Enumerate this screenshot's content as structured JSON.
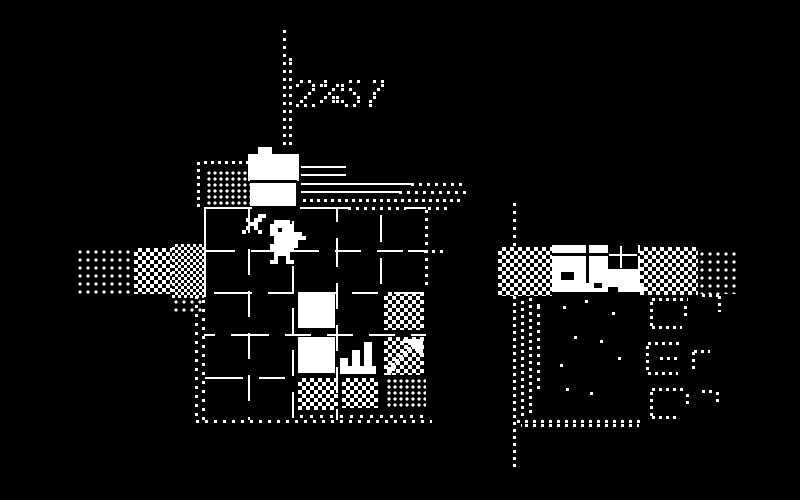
{
  "meta": {
    "title": "1-bit adventure game screen - hotel room with player, crates and neighboring house",
    "background": "#000000",
    "foreground": "#ffffff"
  },
  "hud": {
    "counter": "2%",
    "timer": "57",
    "style": "dotted-pixel-digits"
  },
  "glyphs": {
    "2": [
      ".X.X.",
      "X...X",
      "....X",
      "...X.",
      "..X..",
      ".X...",
      "X.X.X"
    ],
    "%": [
      "XX...",
      "XX..X",
      "...X.",
      "..X..",
      ".X.XX",
      "X..XX",
      "....."
    ],
    "5": [
      "X.X.X",
      "X....",
      "X.X..",
      "...X.",
      "....X",
      "X...X",
      ".X.X."
    ],
    "7": [
      "X.X.X",
      "....X",
      "...X.",
      "..X..",
      "..X..",
      ".X...",
      ".X..."
    ]
  },
  "sprites": {
    "player": [
      "..XXXX....",
      ".XXXXXX...",
      ".XX.XXX...",
      ".XXXXXXXX.",
      "..XXXXXXXX",
      "..XXXXXX..",
      ".XXXXXXX..",
      ".XXXXXX...",
      "..XXXX....",
      "..X..X....",
      ".XX..XX..."
    ],
    "sword": [
      "X...XX",
      ".X.XX.",
      "..XX..",
      ".X.X..",
      "X...X."
    ],
    "stairs": [
      "......XX.",
      "......XX.",
      "...XX.XX.",
      "...XX.XX.",
      "XX.XX.XX.",
      "XX.XX.XX.",
      "XXXXXXXXX",
      "XXXXXXXXX"
    ],
    "arrow": [
      "....XXXXX",
      "......XXX",
      ".....X.XX",
      "....X...X",
      "...X.....",
      "..X......",
      ".X.......",
      "XX.......",
      "X........"
    ]
  },
  "scene": {
    "width": 800,
    "height": 500,
    "elements": [
      {
        "n": "timer-pole-dotted-line",
        "t": "dv",
        "x": 283,
        "y": 30,
        "h": 120,
        "p": 8,
        "d": 3
      },
      {
        "n": "timer-pole-dotted-line-2",
        "t": "dv",
        "x": 289,
        "y": 58,
        "h": 92,
        "p": 8,
        "d": 3,
        "o": 4
      },
      {
        "n": "hud-counter",
        "t": "text",
        "x": 296,
        "y": 80,
        "tx": "2%"
      },
      {
        "n": "hud-timer",
        "t": "text",
        "x": 341,
        "y": 80,
        "tx": "57"
      },
      {
        "n": "roof-dotted-hline",
        "t": "dh",
        "x": 204,
        "y": 161,
        "w": 48,
        "p": 7,
        "d": 3
      },
      {
        "n": "roof-dotted-vline",
        "t": "dv",
        "x": 197,
        "y": 162,
        "h": 46,
        "p": 7,
        "d": 3
      },
      {
        "n": "storage-dither-block",
        "t": "dots",
        "x": 206,
        "y": 170,
        "w": 44,
        "h": 36,
        "p": 6,
        "d": 3
      },
      {
        "n": "reception-desk-tab",
        "t": "rect",
        "x": 258,
        "y": 147,
        "w": 14,
        "h": 8
      },
      {
        "n": "reception-desk-top",
        "t": "rect",
        "x": 248,
        "y": 154,
        "w": 51,
        "h": 27
      },
      {
        "n": "reception-desk-divider",
        "t": "rect",
        "x": 250,
        "y": 180,
        "w": 47,
        "h": 3,
        "c": "#000"
      },
      {
        "n": "reception-desk-front",
        "t": "rect",
        "x": 250,
        "y": 183,
        "w": 46,
        "h": 23
      },
      {
        "n": "shelf-line-1",
        "t": "hl",
        "x": 301,
        "y": 166,
        "w": 45
      },
      {
        "n": "shelf-line-2",
        "t": "hl",
        "x": 301,
        "y": 174,
        "w": 45
      },
      {
        "n": "shelf-line-3",
        "t": "hl",
        "x": 301,
        "y": 183,
        "w": 110
      },
      {
        "n": "shelf-line-3-dotted",
        "t": "dh",
        "x": 411,
        "y": 183,
        "w": 56,
        "p": 8,
        "d": 3
      },
      {
        "n": "shelf-line-4",
        "t": "hl",
        "x": 301,
        "y": 191,
        "w": 98
      },
      {
        "n": "shelf-line-4-dotted",
        "t": "dh",
        "x": 399,
        "y": 191,
        "w": 68,
        "p": 8,
        "d": 3
      },
      {
        "n": "shelf-line-5-dotted",
        "t": "dh",
        "x": 303,
        "y": 199,
        "w": 160,
        "p": 7,
        "d": 3
      },
      {
        "n": "room-top-wall-left",
        "t": "hl",
        "x": 204,
        "y": 207,
        "w": 48
      },
      {
        "n": "room-top-wall-mid",
        "t": "hl",
        "x": 300,
        "y": 207,
        "w": 48
      },
      {
        "n": "room-top-wall-dotted",
        "t": "dh",
        "x": 348,
        "y": 207,
        "w": 58,
        "p": 8,
        "d": 3
      },
      {
        "n": "room-top-wall-right",
        "t": "hl",
        "x": 406,
        "y": 207,
        "w": 20
      },
      {
        "n": "room-top-wall-dotted-2",
        "t": "dh",
        "x": 428,
        "y": 207,
        "w": 22,
        "p": 8,
        "d": 3
      },
      {
        "n": "room-left-wall",
        "t": "vl",
        "x": 204,
        "y": 207,
        "h": 90
      },
      {
        "n": "room-left-wall-dotted",
        "t": "dv",
        "x": 195,
        "y": 296,
        "h": 126,
        "p": 9,
        "d": 3
      },
      {
        "n": "room-left-wall-dotted-2",
        "t": "dv",
        "x": 202,
        "y": 296,
        "h": 126,
        "p": 9,
        "d": 3,
        "o": 4
      },
      {
        "n": "room-right-wall-dotted",
        "t": "dv",
        "x": 425,
        "y": 210,
        "h": 80,
        "p": 8,
        "d": 3
      },
      {
        "n": "room-bottom-wall-dotted",
        "t": "dh",
        "x": 196,
        "y": 420,
        "w": 236,
        "p": 9,
        "d": 3
      },
      {
        "n": "side-window-line",
        "t": "hl",
        "x": 408,
        "y": 250,
        "w": 14
      },
      {
        "n": "side-window-dotted",
        "t": "dh",
        "x": 424,
        "y": 250,
        "w": 22,
        "p": 8,
        "d": 3
      },
      {
        "n": "floor-grid-vline",
        "t": "dsv",
        "x": 248,
        "y": 207,
        "h": 213,
        "o": 0
      },
      {
        "n": "floor-grid-vline",
        "t": "dsv",
        "x": 292,
        "y": 207,
        "h": 213,
        "o": 17
      },
      {
        "n": "floor-grid-vline",
        "t": "dsv",
        "x": 336,
        "y": 207,
        "h": 213,
        "o": 34
      },
      {
        "n": "floor-grid-vline",
        "t": "dsv",
        "x": 380,
        "y": 207,
        "h": 85,
        "o": 9
      },
      {
        "n": "floor-grid-hline",
        "t": "dsh",
        "x": 204,
        "y": 250,
        "w": 222,
        "o": 5
      },
      {
        "n": "floor-grid-hline",
        "t": "dsh",
        "x": 204,
        "y": 292,
        "w": 222,
        "o": 22
      },
      {
        "n": "floor-grid-hline",
        "t": "dsh",
        "x": 204,
        "y": 334,
        "w": 222,
        "o": 39
      },
      {
        "n": "floor-grid-hline",
        "t": "dsh",
        "x": 204,
        "y": 377,
        "w": 96,
        "o": 13
      },
      {
        "n": "crate-tile",
        "t": "rect",
        "x": 298,
        "y": 292,
        "w": 37,
        "h": 36
      },
      {
        "n": "crate-tile",
        "t": "rect",
        "x": 298,
        "y": 337,
        "w": 37,
        "h": 36
      },
      {
        "n": "stairs-tile",
        "t": "sprite",
        "x": 340,
        "y": 342,
        "sp": "stairs",
        "s": 4
      },
      {
        "n": "checker-tile",
        "t": "checker",
        "x": 384,
        "y": 292,
        "w": 40,
        "h": 38,
        "c2": 8
      },
      {
        "n": "checker-tile",
        "t": "checker",
        "x": 384,
        "y": 337,
        "w": 40,
        "h": 38,
        "c2": 8
      },
      {
        "n": "arrow-overlay",
        "t": "sprite",
        "x": 387,
        "y": 339,
        "sp": "arrow",
        "s": 4
      },
      {
        "n": "checker-tile",
        "t": "checker",
        "x": 298,
        "y": 378,
        "w": 40,
        "h": 32,
        "c2": 8
      },
      {
        "n": "checker-tile",
        "t": "checker",
        "x": 342,
        "y": 378,
        "w": 36,
        "h": 30,
        "c2": 8
      },
      {
        "n": "dot-tile",
        "t": "dots",
        "x": 386,
        "y": 378,
        "w": 40,
        "h": 30,
        "p": 6,
        "d": 3
      },
      {
        "n": "floor-dots-bottom",
        "t": "dh",
        "x": 300,
        "y": 415,
        "w": 130,
        "p": 10,
        "d": 3
      },
      {
        "n": "player-sword",
        "t": "sprite",
        "x": 242,
        "y": 214,
        "sp": "sword",
        "s": 4
      },
      {
        "n": "player-character",
        "t": "sprite",
        "x": 266,
        "y": 220,
        "sp": "player",
        "s": 4
      },
      {
        "n": "path-dots",
        "t": "dots",
        "x": 76,
        "y": 248,
        "w": 58,
        "h": 46,
        "p": 8,
        "d": 3
      },
      {
        "n": "path-checker",
        "t": "checker",
        "x": 134,
        "y": 248,
        "w": 38,
        "h": 46,
        "c2": 8
      },
      {
        "n": "path-checker-dense",
        "t": "checker",
        "x": 172,
        "y": 244,
        "w": 32,
        "h": 54,
        "c2": 6
      },
      {
        "n": "path-dots-lower",
        "t": "dots",
        "x": 172,
        "y": 298,
        "w": 32,
        "h": 16,
        "p": 8,
        "d": 3
      },
      {
        "n": "yard-checker-left",
        "t": "checker",
        "x": 498,
        "y": 247,
        "w": 54,
        "h": 49,
        "c2": 8
      },
      {
        "n": "facade",
        "t": "rect",
        "x": 552,
        "y": 245,
        "w": 88,
        "h": 38
      },
      {
        "n": "facade-trim",
        "t": "rect",
        "x": 552,
        "y": 253,
        "w": 88,
        "h": 3,
        "c": "#000"
      },
      {
        "n": "facade-divider",
        "t": "rect",
        "x": 586,
        "y": 245,
        "w": 3,
        "h": 38,
        "c": "#000"
      },
      {
        "n": "facade-divider-2",
        "t": "rect",
        "x": 627,
        "y": 245,
        "w": 2,
        "h": 17,
        "c": "#000"
      },
      {
        "n": "facade-window",
        "t": "rect",
        "x": 608,
        "y": 245,
        "w": 30,
        "h": 24,
        "c": "#000"
      },
      {
        "n": "facade-window-mullion-v",
        "t": "rect",
        "x": 620,
        "y": 246,
        "w": 2,
        "h": 22
      },
      {
        "n": "facade-window-mullion-h",
        "t": "rect",
        "x": 609,
        "y": 254,
        "w": 28,
        "h": 2
      },
      {
        "n": "facade-door",
        "t": "rect",
        "x": 561,
        "y": 272,
        "w": 13,
        "h": 8,
        "c": "#000"
      },
      {
        "n": "porch-strip",
        "t": "rect",
        "x": 552,
        "y": 283,
        "w": 92,
        "h": 9
      },
      {
        "n": "porch-mark",
        "t": "rect",
        "x": 594,
        "y": 283,
        "w": 8,
        "h": 5,
        "c": "#000"
      },
      {
        "n": "porch-mark-2",
        "t": "rect",
        "x": 608,
        "y": 287,
        "w": 10,
        "h": 5,
        "c": "#000"
      },
      {
        "n": "yard-checker-right",
        "t": "checker",
        "x": 640,
        "y": 247,
        "w": 58,
        "h": 48,
        "c2": 8
      },
      {
        "n": "yard-dots-right",
        "t": "dots",
        "x": 698,
        "y": 250,
        "w": 42,
        "h": 44,
        "p": 8,
        "d": 3
      },
      {
        "n": "lamp-post-dotted-top",
        "t": "dv",
        "x": 513,
        "y": 203,
        "h": 44,
        "p": 8,
        "d": 3
      },
      {
        "n": "lamp-post-dotted",
        "t": "dv",
        "x": 513,
        "y": 296,
        "h": 172,
        "p": 7,
        "d": 3
      },
      {
        "n": "fence-dotted-1",
        "t": "dv",
        "x": 521,
        "y": 298,
        "h": 118,
        "p": 7,
        "d": 3,
        "o": 3
      },
      {
        "n": "fence-dotted-2",
        "t": "dv",
        "x": 529,
        "y": 298,
        "h": 118,
        "p": 7,
        "d": 3
      },
      {
        "n": "fence-dotted-3",
        "t": "dv",
        "x": 537,
        "y": 302,
        "h": 90,
        "p": 8,
        "d": 3,
        "o": 4
      },
      {
        "n": "shore-dotted",
        "t": "dh",
        "x": 517,
        "y": 420,
        "w": 124,
        "p": 8,
        "d": 3
      },
      {
        "n": "shore-dotted-2",
        "t": "dh",
        "x": 521,
        "y": 424,
        "w": 118,
        "p": 8,
        "d": 3,
        "o": 4
      },
      {
        "n": "hedge-segment",
        "t": "dh",
        "x": 652,
        "y": 298,
        "w": 36,
        "p": 7,
        "d": 3
      },
      {
        "n": "hedge-segment",
        "t": "dv",
        "x": 650,
        "y": 302,
        "h": 24,
        "p": 7,
        "d": 3
      },
      {
        "n": "hedge-segment",
        "t": "dh",
        "x": 652,
        "y": 326,
        "w": 30,
        "p": 7,
        "d": 3
      },
      {
        "n": "hedge-segment",
        "t": "dv",
        "x": 684,
        "y": 306,
        "h": 14,
        "p": 7,
        "d": 3
      },
      {
        "n": "hedge-segment",
        "t": "dh",
        "x": 702,
        "y": 294,
        "w": 18,
        "p": 7,
        "d": 3
      },
      {
        "n": "hedge-segment",
        "t": "dv",
        "x": 718,
        "y": 296,
        "h": 16,
        "p": 7,
        "d": 3
      },
      {
        "n": "hedge-segment",
        "t": "dh",
        "x": 648,
        "y": 342,
        "w": 34,
        "p": 7,
        "d": 3
      },
      {
        "n": "hedge-segment",
        "t": "dv",
        "x": 646,
        "y": 346,
        "h": 26,
        "p": 7,
        "d": 3
      },
      {
        "n": "hedge-segment",
        "t": "dh",
        "x": 648,
        "y": 372,
        "w": 30,
        "p": 7,
        "d": 3
      },
      {
        "n": "hedge-segment",
        "t": "dh",
        "x": 660,
        "y": 357,
        "w": 20,
        "p": 7,
        "d": 3
      },
      {
        "n": "hedge-segment",
        "t": "dv",
        "x": 692,
        "y": 352,
        "h": 20,
        "p": 7,
        "d": 3
      },
      {
        "n": "hedge-segment",
        "t": "dh",
        "x": 694,
        "y": 350,
        "w": 16,
        "p": 7,
        "d": 3
      },
      {
        "n": "hedge-segment",
        "t": "dh",
        "x": 652,
        "y": 388,
        "w": 34,
        "p": 7,
        "d": 3
      },
      {
        "n": "hedge-segment",
        "t": "dv",
        "x": 650,
        "y": 392,
        "h": 24,
        "p": 7,
        "d": 3
      },
      {
        "n": "hedge-segment",
        "t": "dh",
        "x": 652,
        "y": 416,
        "w": 28,
        "p": 7,
        "d": 3
      },
      {
        "n": "hedge-segment",
        "t": "dv",
        "x": 686,
        "y": 394,
        "h": 12,
        "p": 7,
        "d": 3
      },
      {
        "n": "hedge-segment",
        "t": "dh",
        "x": 702,
        "y": 390,
        "w": 14,
        "p": 7,
        "d": 3
      },
      {
        "n": "hedge-segment",
        "t": "dv",
        "x": 716,
        "y": 392,
        "h": 14,
        "p": 7,
        "d": 3
      },
      {
        "n": "ground-dot",
        "t": "rect",
        "x": 563,
        "y": 306,
        "w": 3,
        "h": 3
      },
      {
        "n": "ground-dot",
        "t": "rect",
        "x": 585,
        "y": 300,
        "w": 3,
        "h": 3
      },
      {
        "n": "ground-dot",
        "t": "rect",
        "x": 574,
        "y": 336,
        "w": 3,
        "h": 3
      },
      {
        "n": "ground-dot",
        "t": "rect",
        "x": 560,
        "y": 364,
        "w": 3,
        "h": 3
      },
      {
        "n": "ground-dot",
        "t": "rect",
        "x": 590,
        "y": 392,
        "w": 3,
        "h": 3
      },
      {
        "n": "ground-dot",
        "t": "rect",
        "x": 612,
        "y": 312,
        "w": 3,
        "h": 3
      },
      {
        "n": "ground-dot",
        "t": "rect",
        "x": 600,
        "y": 340,
        "w": 3,
        "h": 3
      },
      {
        "n": "ground-dot",
        "t": "rect",
        "x": 618,
        "y": 357,
        "w": 3,
        "h": 3
      },
      {
        "n": "ground-dot",
        "t": "rect",
        "x": 566,
        "y": 388,
        "w": 3,
        "h": 3
      }
    ]
  }
}
